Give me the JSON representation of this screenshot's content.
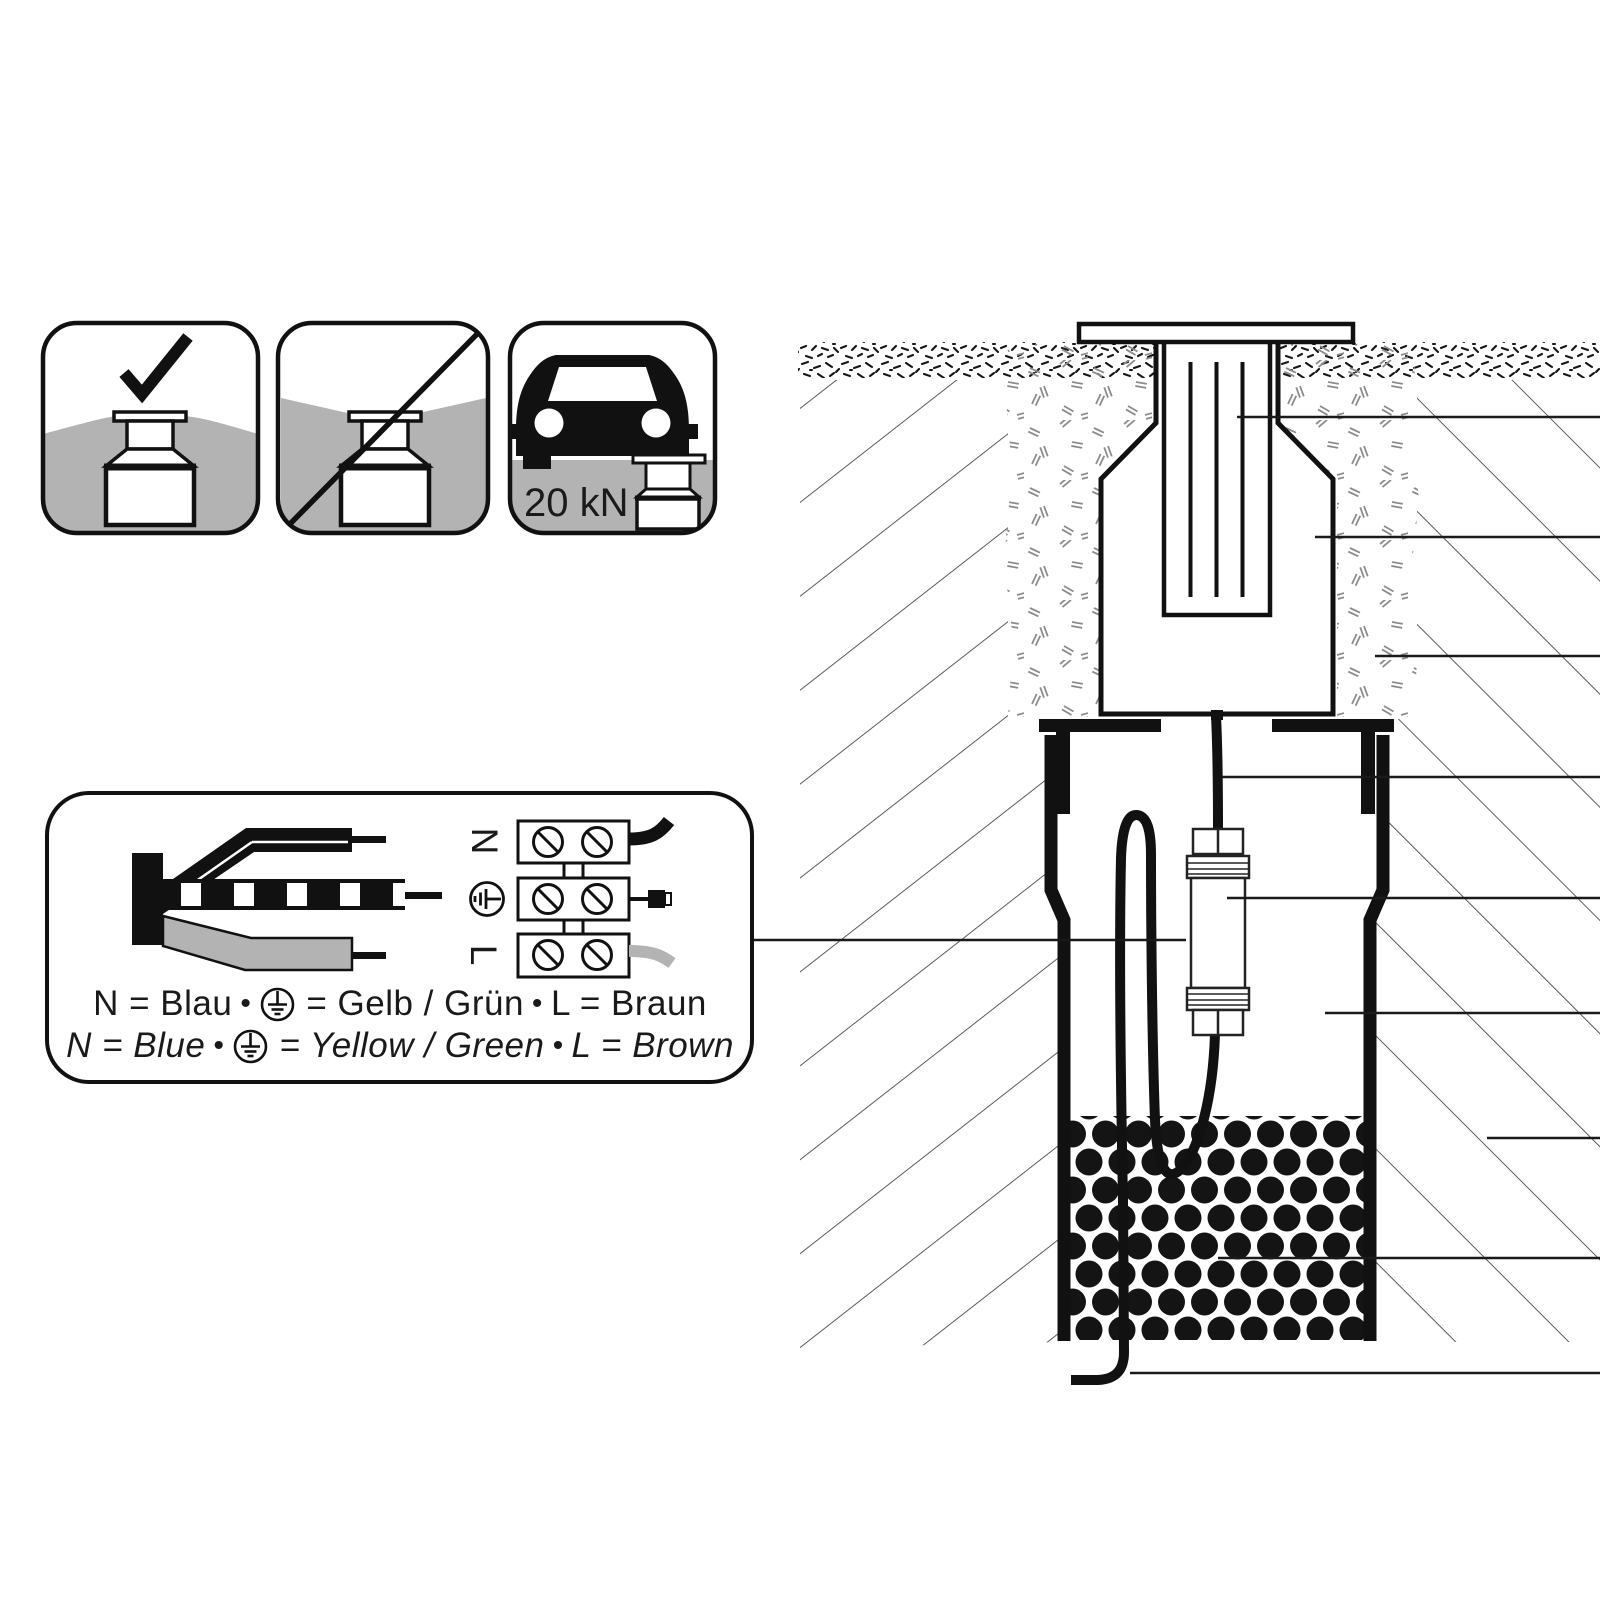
{
  "page": {
    "background": "#ffffff"
  },
  "colors": {
    "ink": "#1a1a1a",
    "ground_gray": "#b3b3b3",
    "sand_mark": "#8c8c8c",
    "hatch": "#3f3f3f"
  },
  "icons": {
    "correct_installation": {
      "meaning": "check-mark-flush-ground-mounting"
    },
    "wrong_installation": {
      "meaning": "crossed-out-mounting-in-depression"
    },
    "load_rating": {
      "label": "20 kN"
    }
  },
  "wiring": {
    "terminal_n": "N",
    "terminal_l": "L",
    "legend_de": {
      "part1": "N = Blau",
      "bullet1": "•",
      "part2": "= Gelb / Grün",
      "bullet2": "•",
      "part3": "L = Braun"
    },
    "legend_en": {
      "part1": "N = Blue",
      "bullet1": "•",
      "part2": "= Yellow / Green",
      "bullet2": "•",
      "part3": "L = Brown"
    }
  }
}
